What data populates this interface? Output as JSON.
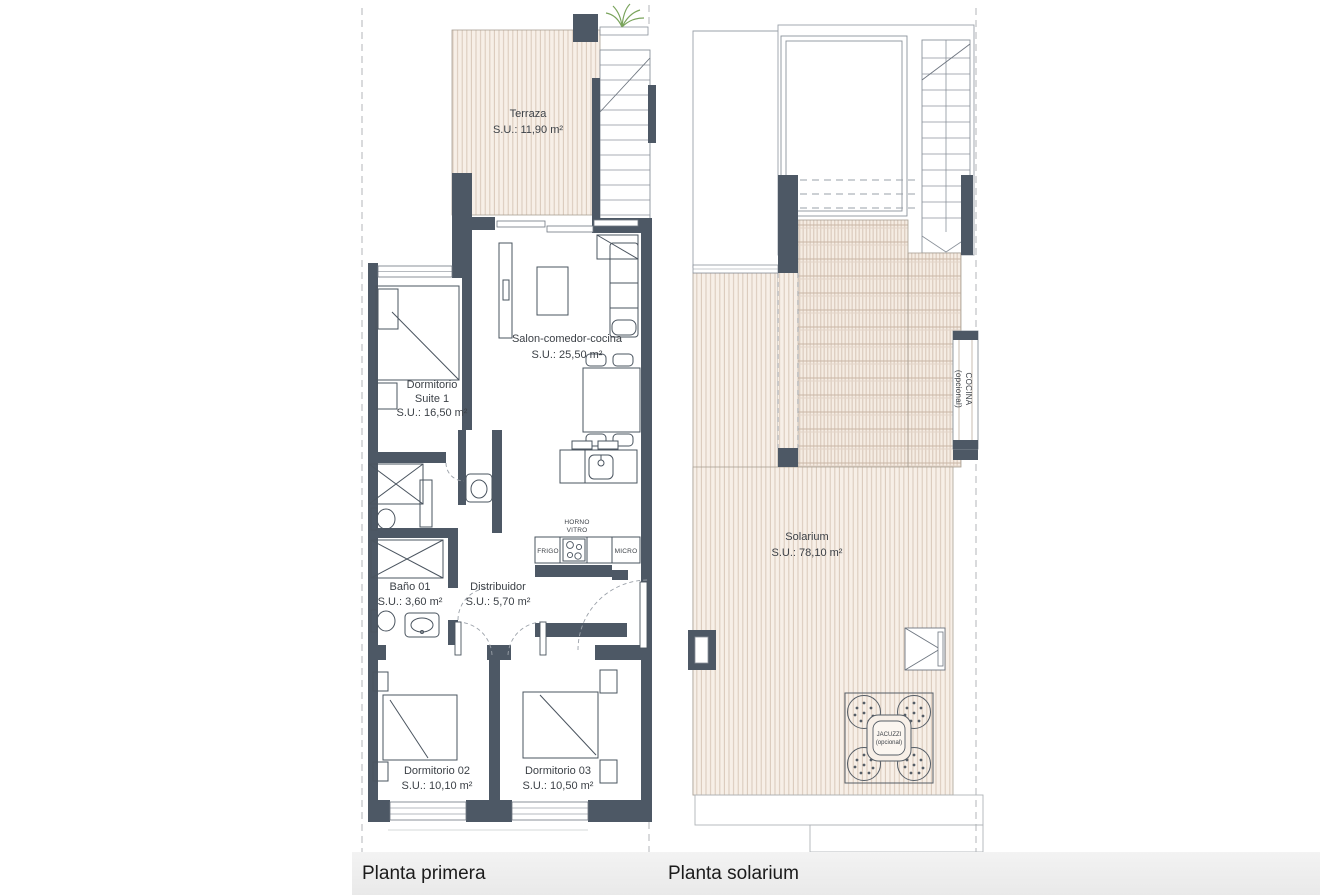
{
  "colors": {
    "wall": "#4d5865",
    "hatch_bg": "#f7efe7",
    "hatch_line": "#d9c8ba",
    "furniture_line": "#4a545f",
    "thin_line": "#9aa0a8",
    "footer_bg": "#ececec",
    "plant": "#7aa45c",
    "text": "#3c4147"
  },
  "plans": {
    "primera": {
      "caption": "Planta primera",
      "rooms": {
        "terraza": {
          "name": "Terraza",
          "area": "S.U.: 11,90 m²"
        },
        "salon": {
          "name": "Salon-comedor-cocina",
          "area": "S.U.: 25,50 m²"
        },
        "suite1": {
          "name_line1": "Dormitorio",
          "name_line2": "Suite 1",
          "area": "S.U.: 16,50 m²"
        },
        "bano01": {
          "name": "Baño 01",
          "area": "S.U.: 3,60 m²"
        },
        "distribuidor": {
          "name": "Distribuidor",
          "area": "S.U.: 5,70 m²"
        },
        "dorm02": {
          "name": "Dormitorio 02",
          "area": "S.U.: 10,10 m²"
        },
        "dorm03": {
          "name": "Dormitorio 03",
          "area": "S.U.: 10,50 m²"
        }
      },
      "appliances": {
        "horno_line1": "HORNO",
        "horno_line2": "VITRO",
        "frigo": "FRIGO",
        "micro": "MICRO"
      }
    },
    "solarium": {
      "caption": "Planta solarium",
      "rooms": {
        "solarium": {
          "name": "Solarium",
          "area": "S.U.: 78,10 m²"
        },
        "cocina": {
          "name_line1": "COCINA",
          "name_line2": "(opcional)"
        },
        "jacuzzi": {
          "name_line1": "JACUZZI",
          "name_line2": "(opcional)"
        }
      }
    }
  }
}
